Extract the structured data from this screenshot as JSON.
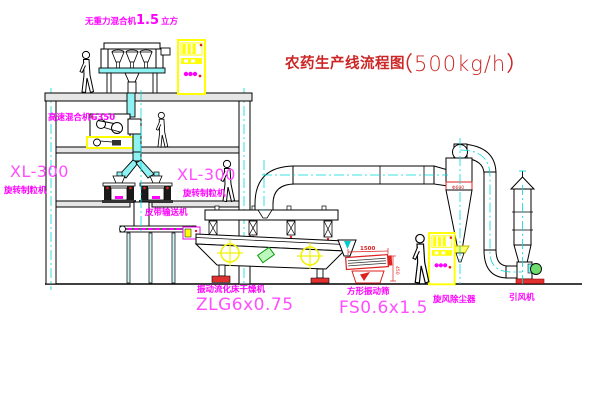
{
  "title": {
    "text": "农药生产线流程图",
    "capacity": "（500kg/h）"
  },
  "labels": {
    "gravity_mixer": {
      "prefix": "无重力混合机",
      "size": "1.5",
      "suffix": "立方"
    },
    "high_speed_mixer": "高速混合机G350",
    "granulator_left": {
      "model": "XL-300",
      "name": "旋转制粒机"
    },
    "granulator_right": {
      "model": "XL-300",
      "name": "旋转制粒机"
    },
    "belt_conveyor": "皮带输送机",
    "dryer": {
      "name": "振动流化床干燥机",
      "model": "ZLG6x0.75"
    },
    "screen": {
      "name": "方形振动筛",
      "model": "FS0.6x1.5"
    },
    "cyclone": "旋风除尘器",
    "fan": "引风机"
  },
  "dimensions": {
    "screen_length": "1500",
    "screen_height": "450",
    "cyclone_marking": "Φ600"
  },
  "colors": {
    "label_magenta": "#ff00ff",
    "model_magenta": "#ff4dff",
    "title_red": "#cc2626",
    "dim_red": "#dd2222",
    "pipe_cyan": "#8ef2f2",
    "centerline_cyan": "#00d9d9",
    "highlight_yellow": "#ffff00"
  }
}
